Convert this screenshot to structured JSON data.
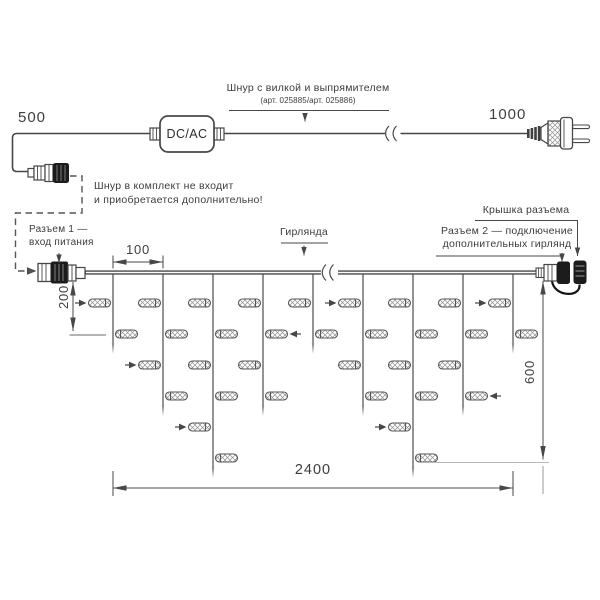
{
  "power_cord": {
    "length_left": "500",
    "length_right": "1000",
    "adapter": "DC/AC",
    "title": "Шнур с вилкой и выпрямителем",
    "subtitle": "(арт. 025885/арт. 025886)",
    "note_line1": "Шнур в комплект не входит",
    "note_line2": "и приобретается дополнительно!"
  },
  "garland": {
    "name_label": "Гирлянда",
    "connector1_label_line1": "Разъем 1 —",
    "connector1_label_line2": "вход питания",
    "connector2_label_line1": "Разъем 2 — подключение",
    "connector2_label_line2": "дополнительных гирлянд",
    "cap_label": "Крышка разъема",
    "dimensions": {
      "drop_spacing_mm": "100",
      "short_drop_mm": "200",
      "max_drop_mm": "600",
      "total_length_mm": "2400"
    },
    "structure": {
      "drops_light_counts": [
        2,
        4,
        6,
        4,
        2,
        4,
        6,
        4,
        2
      ],
      "flash_bulbs": [
        [
          1,
          1
        ],
        [
          2,
          3
        ],
        [
          3,
          5
        ],
        [
          4,
          2
        ],
        [
          6,
          1
        ],
        [
          7,
          5
        ],
        [
          8,
          4
        ],
        [
          9,
          1
        ]
      ]
    }
  },
  "colors": {
    "line": "#474747",
    "drop": "#949494",
    "text": "#3d3d3d"
  }
}
